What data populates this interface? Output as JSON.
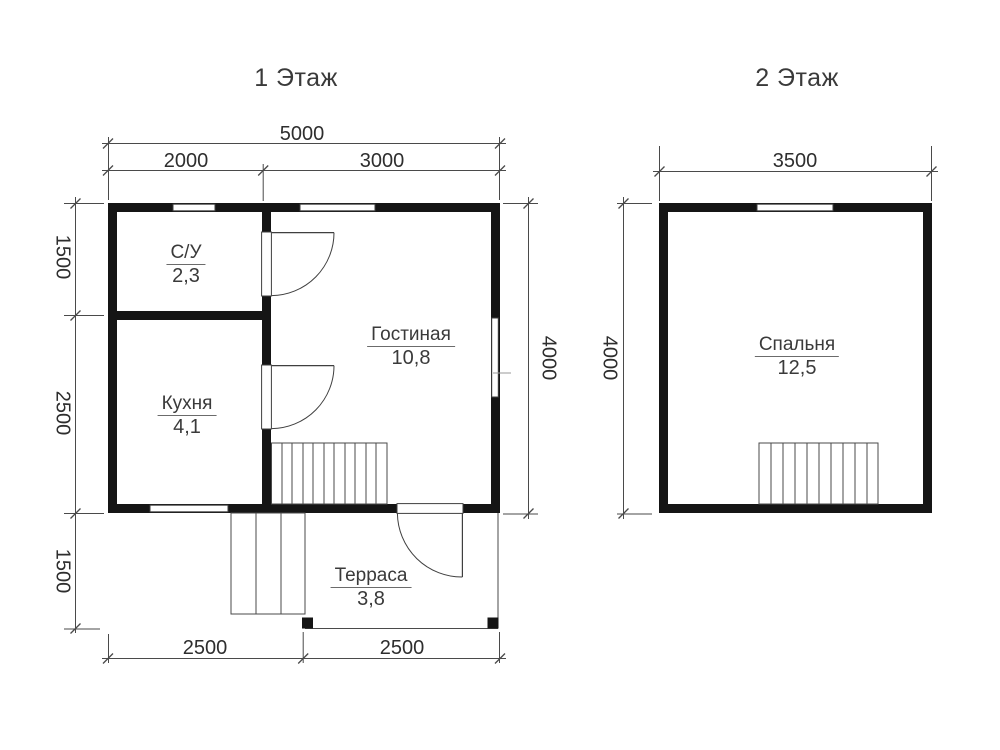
{
  "colors": {
    "wall": "#151515",
    "thin_line": "#4a4a4a",
    "text": "#333333",
    "background": "#ffffff"
  },
  "floor1": {
    "title": "1 Этаж",
    "dims": {
      "top_total": "5000",
      "top_left": "2000",
      "top_right": "3000",
      "side_upper": "1500",
      "side_middle": "2500",
      "side_lower": "1500",
      "right": "4000",
      "bottom_left": "2500",
      "bottom_right": "2500"
    },
    "rooms": [
      {
        "name": "С/У",
        "area": "2,3"
      },
      {
        "name": "Кухня",
        "area": "4,1"
      },
      {
        "name": "Гостиная",
        "area": "10,8"
      },
      {
        "name": "Терраса",
        "area": "3,8"
      }
    ]
  },
  "floor2": {
    "title": "2 Этаж",
    "dims": {
      "top_total": "3500",
      "side": "4000"
    },
    "rooms": [
      {
        "name": "Спальня",
        "area": "12,5"
      }
    ]
  }
}
